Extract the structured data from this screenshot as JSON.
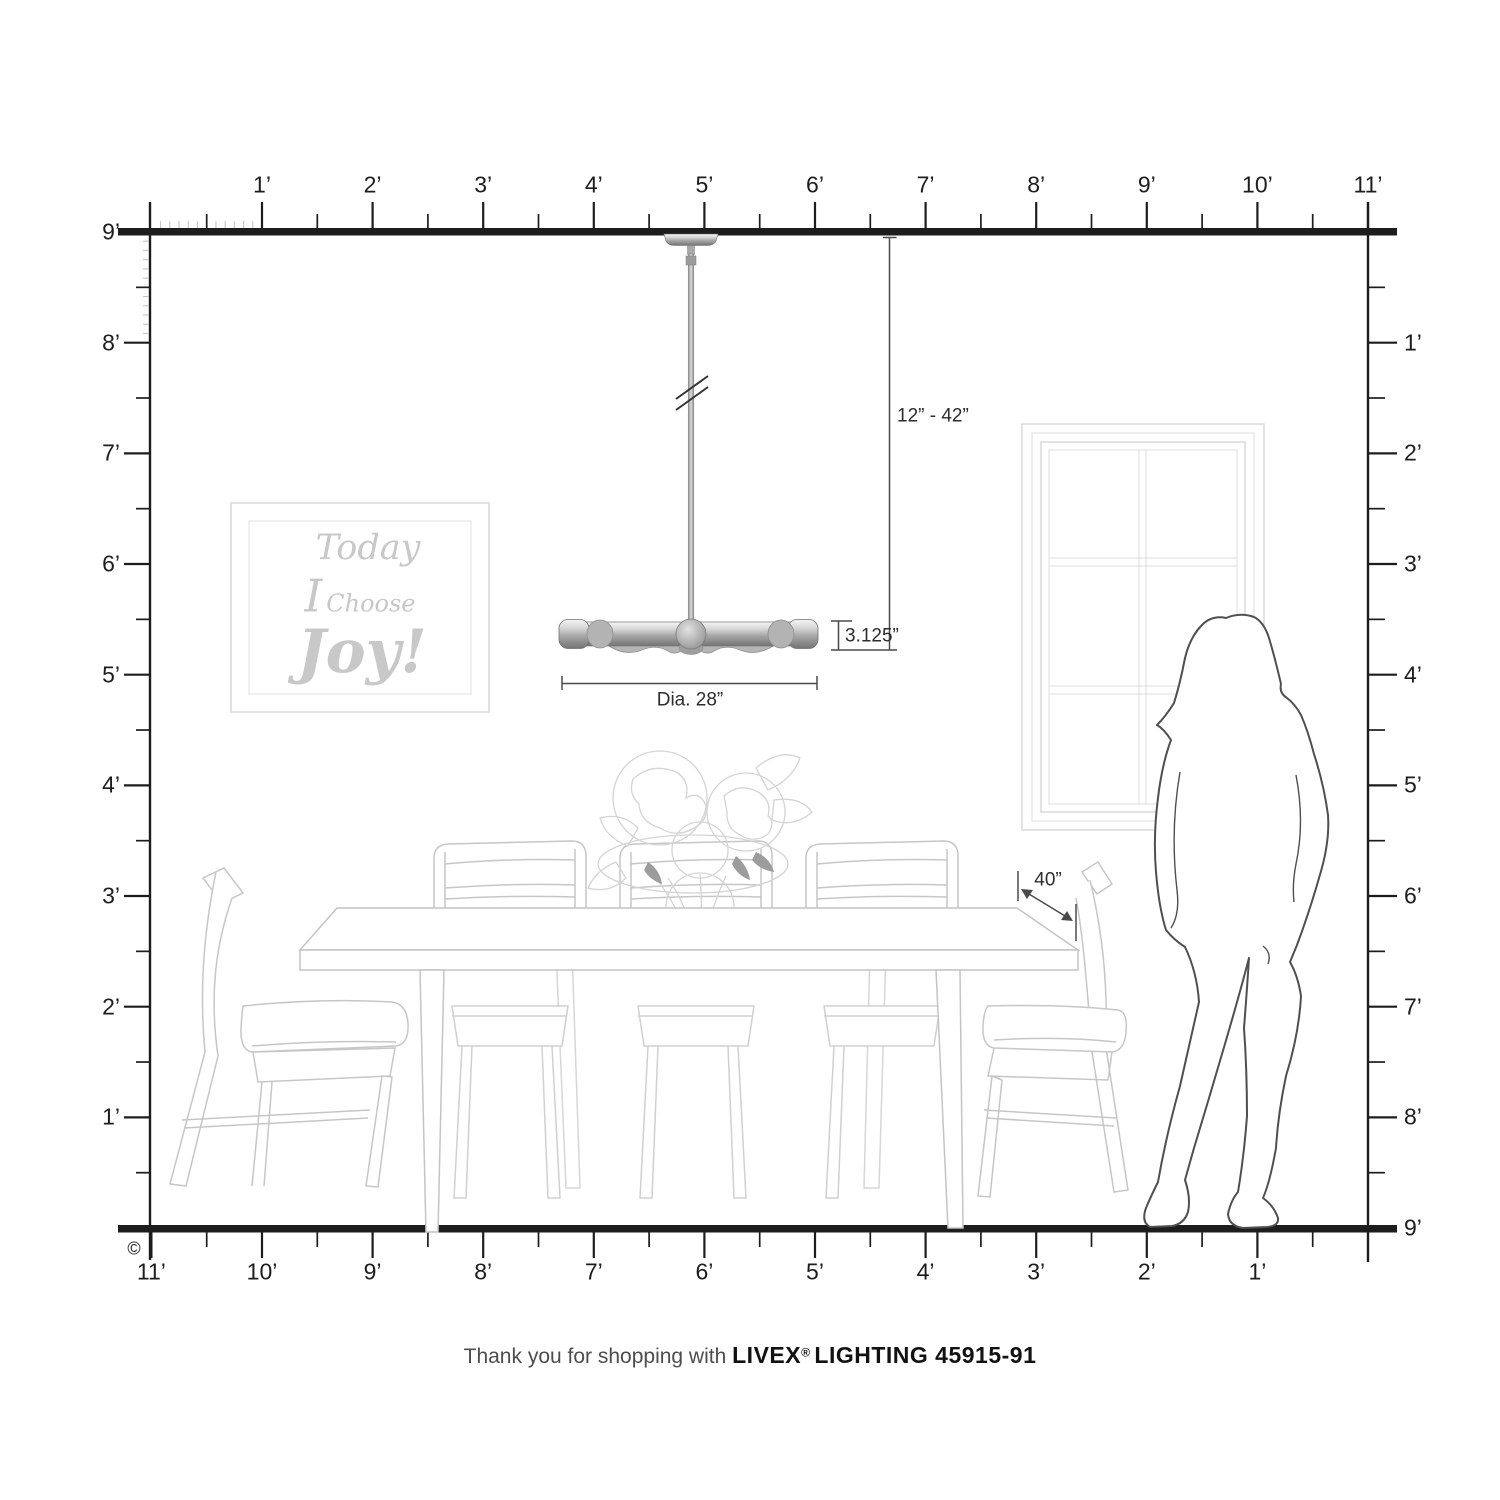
{
  "rulers": {
    "unit": "feet",
    "top": [
      "1’",
      "2’",
      "3’",
      "4’",
      "5’",
      "6’",
      "7’",
      "8’",
      "9’",
      "10’",
      "11’"
    ],
    "bottom": [
      "11’",
      "10’",
      "9’",
      "8’",
      "7’",
      "6’",
      "5’",
      "4’",
      "3’",
      "2’",
      "1’"
    ],
    "left": [
      "9’",
      "8’",
      "7’",
      "6’",
      "5’",
      "4’",
      "3’",
      "2’",
      "1’"
    ],
    "right": [
      "1’",
      "2’",
      "3’",
      "4’",
      "5’",
      "6’",
      "7’",
      "8’",
      "9’"
    ]
  },
  "dimensions": {
    "hang_range": "12” - 42”",
    "fixture_height": "3.125”",
    "fixture_diameter": "Dia. 28”",
    "table_width": "40”"
  },
  "wall_art": {
    "line1": "Today",
    "line2_initial": "I",
    "line2_rest": "Choose",
    "line3": "Joy!"
  },
  "copyright_symbol": "©",
  "footer": {
    "prefix": "Thank you for shopping with ",
    "brand": "LIVEX",
    "registered": "®",
    "product": "LIGHTING 45915-91"
  },
  "colors": {
    "ruler": "#1d1d1d",
    "dimension_line": "#4a4a4a",
    "sketch": "#c6c6c6",
    "sketch_light": "#d8d8d8",
    "window": "#dcdcdc",
    "silhouette_outline": "#4f4f4f",
    "metal_mid": "#a8a8a8"
  }
}
